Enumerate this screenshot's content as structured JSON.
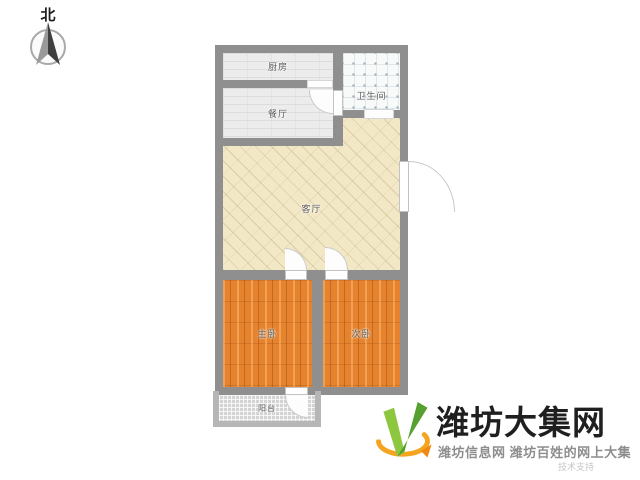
{
  "compass": {
    "north_label": "北"
  },
  "floorplan": {
    "wall_color": "#8f8f8f",
    "rooms": [
      {
        "name": "kitchen",
        "label": "厨房",
        "floor": "tile-gray"
      },
      {
        "name": "dining",
        "label": "餐厅",
        "floor": "tile-gray"
      },
      {
        "name": "bathroom",
        "label": "卫生间",
        "floor": "tile-white-dot"
      },
      {
        "name": "living",
        "label": "客厅",
        "floor": "parquet-cream"
      },
      {
        "name": "master_bedroom",
        "label": "主卧",
        "floor": "wood-orange"
      },
      {
        "name": "second_bedroom",
        "label": "次卧",
        "floor": "wood-orange"
      },
      {
        "name": "balcony",
        "label": "阳台",
        "floor": "tile-small-gray"
      }
    ]
  },
  "branding": {
    "site_name": "潍坊大集网",
    "tagline": "潍坊信息网 潍坊百姓的网上大集",
    "watermark": "技术支持",
    "colors": {
      "green": "#8dc63f",
      "dark_green": "#55a02e",
      "orange": "#f6a41f",
      "text": "#1f1f1f",
      "tagline_gray": "#8d8d8d"
    }
  }
}
